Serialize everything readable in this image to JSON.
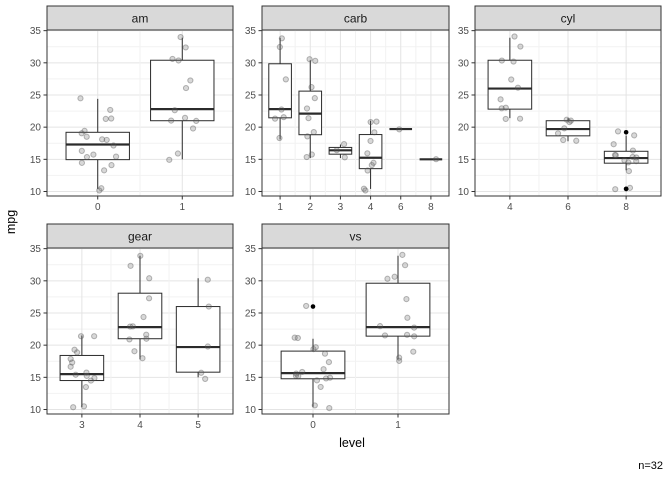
{
  "figure": {
    "y_axis_title": "mpg",
    "x_axis_title": "level",
    "caption": "n=32"
  },
  "style": {
    "background": "#ffffff",
    "strip_bg": "#d9d9d9",
    "strip_text": "#1a1a1a",
    "panel_border": "#333333",
    "grid_major": "#e4e4e4",
    "grid_minor": "#f2f2f2",
    "box_stroke": "#2b2b2b",
    "box_fill": "#ffffff",
    "axis_text": "#4d4d4d",
    "tick_mark": "#333333",
    "point_fill": "rgba(100,100,100,0.25)",
    "point_stroke": "rgba(80,80,80,0.4)",
    "outlier_color": "#000000"
  },
  "chart_data": {
    "type": "boxplot",
    "description": "mpg by factor level, faceted by variable (facet strips: am, carb, cyl, gear, vs); boxplots with jittered raw points; 1.5*IQR whiskers; outliers as solid black dots",
    "y_ticks": [
      10,
      15,
      20,
      25,
      30,
      35
    ],
    "y_minor_ticks": [
      12.5,
      17.5,
      22.5,
      27.5,
      32.5
    ],
    "y_range": [
      9.3,
      35.1
    ],
    "n": 32,
    "facets": [
      {
        "label": "am",
        "categories": [
          "0",
          "1"
        ]
      },
      {
        "label": "carb",
        "categories": [
          "1",
          "2",
          "3",
          "4",
          "6",
          "8"
        ]
      },
      {
        "label": "cyl",
        "categories": [
          "4",
          "6",
          "8"
        ]
      },
      {
        "label": "gear",
        "categories": [
          "3",
          "4",
          "5"
        ]
      },
      {
        "label": "vs",
        "categories": [
          "0",
          "1"
        ]
      }
    ],
    "observations": [
      {
        "mpg": 21.0,
        "cyl": 6,
        "vs": 0,
        "am": 1,
        "gear": 4,
        "carb": 4
      },
      {
        "mpg": 21.0,
        "cyl": 6,
        "vs": 0,
        "am": 1,
        "gear": 4,
        "carb": 4
      },
      {
        "mpg": 22.8,
        "cyl": 4,
        "vs": 1,
        "am": 1,
        "gear": 4,
        "carb": 1
      },
      {
        "mpg": 21.4,
        "cyl": 6,
        "vs": 1,
        "am": 0,
        "gear": 3,
        "carb": 1
      },
      {
        "mpg": 18.7,
        "cyl": 8,
        "vs": 0,
        "am": 0,
        "gear": 3,
        "carb": 2
      },
      {
        "mpg": 18.1,
        "cyl": 6,
        "vs": 1,
        "am": 0,
        "gear": 3,
        "carb": 1
      },
      {
        "mpg": 14.3,
        "cyl": 8,
        "vs": 0,
        "am": 0,
        "gear": 3,
        "carb": 4
      },
      {
        "mpg": 24.4,
        "cyl": 4,
        "vs": 1,
        "am": 0,
        "gear": 4,
        "carb": 2
      },
      {
        "mpg": 22.8,
        "cyl": 4,
        "vs": 1,
        "am": 0,
        "gear": 4,
        "carb": 2
      },
      {
        "mpg": 19.2,
        "cyl": 6,
        "vs": 1,
        "am": 0,
        "gear": 4,
        "carb": 4
      },
      {
        "mpg": 17.8,
        "cyl": 6,
        "vs": 1,
        "am": 0,
        "gear": 4,
        "carb": 4
      },
      {
        "mpg": 16.4,
        "cyl": 8,
        "vs": 0,
        "am": 0,
        "gear": 3,
        "carb": 3
      },
      {
        "mpg": 17.3,
        "cyl": 8,
        "vs": 0,
        "am": 0,
        "gear": 3,
        "carb": 3
      },
      {
        "mpg": 15.2,
        "cyl": 8,
        "vs": 0,
        "am": 0,
        "gear": 3,
        "carb": 3
      },
      {
        "mpg": 10.4,
        "cyl": 8,
        "vs": 0,
        "am": 0,
        "gear": 3,
        "carb": 4
      },
      {
        "mpg": 10.4,
        "cyl": 8,
        "vs": 0,
        "am": 0,
        "gear": 3,
        "carb": 4
      },
      {
        "mpg": 14.7,
        "cyl": 8,
        "vs": 0,
        "am": 0,
        "gear": 3,
        "carb": 4
      },
      {
        "mpg": 32.4,
        "cyl": 4,
        "vs": 1,
        "am": 1,
        "gear": 4,
        "carb": 1
      },
      {
        "mpg": 30.4,
        "cyl": 4,
        "vs": 1,
        "am": 1,
        "gear": 4,
        "carb": 2
      },
      {
        "mpg": 33.9,
        "cyl": 4,
        "vs": 1,
        "am": 1,
        "gear": 4,
        "carb": 1
      },
      {
        "mpg": 21.5,
        "cyl": 4,
        "vs": 1,
        "am": 0,
        "gear": 3,
        "carb": 1
      },
      {
        "mpg": 15.5,
        "cyl": 8,
        "vs": 0,
        "am": 0,
        "gear": 3,
        "carb": 2
      },
      {
        "mpg": 15.2,
        "cyl": 8,
        "vs": 0,
        "am": 0,
        "gear": 3,
        "carb": 2
      },
      {
        "mpg": 13.3,
        "cyl": 8,
        "vs": 0,
        "am": 0,
        "gear": 3,
        "carb": 4
      },
      {
        "mpg": 19.2,
        "cyl": 8,
        "vs": 0,
        "am": 0,
        "gear": 3,
        "carb": 2
      },
      {
        "mpg": 27.3,
        "cyl": 4,
        "vs": 1,
        "am": 1,
        "gear": 4,
        "carb": 1
      },
      {
        "mpg": 26.0,
        "cyl": 4,
        "vs": 0,
        "am": 1,
        "gear": 5,
        "carb": 2
      },
      {
        "mpg": 30.4,
        "cyl": 4,
        "vs": 1,
        "am": 1,
        "gear": 5,
        "carb": 2
      },
      {
        "mpg": 15.8,
        "cyl": 8,
        "vs": 0,
        "am": 1,
        "gear": 5,
        "carb": 4
      },
      {
        "mpg": 19.7,
        "cyl": 6,
        "vs": 0,
        "am": 1,
        "gear": 5,
        "carb": 6
      },
      {
        "mpg": 15.0,
        "cyl": 8,
        "vs": 0,
        "am": 1,
        "gear": 5,
        "carb": 8
      },
      {
        "mpg": 21.4,
        "cyl": 4,
        "vs": 1,
        "am": 1,
        "gear": 4,
        "carb": 2
      }
    ]
  }
}
